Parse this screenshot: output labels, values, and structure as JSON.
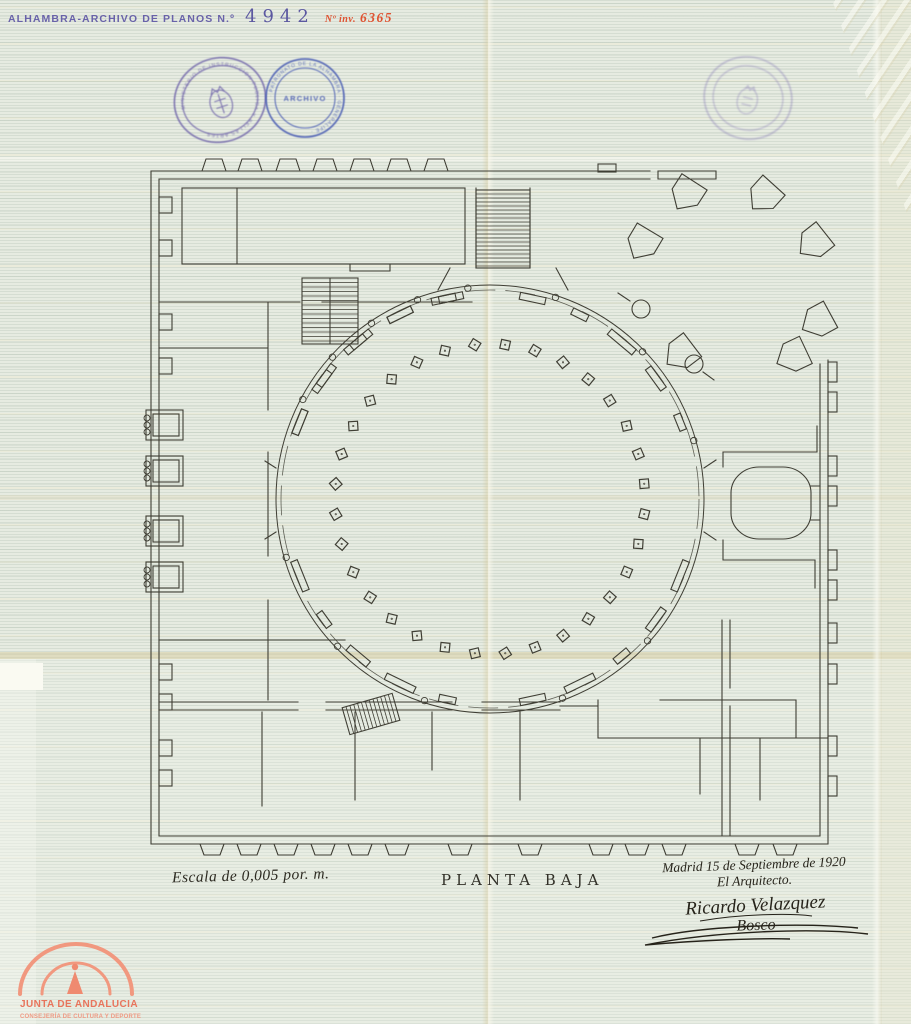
{
  "document": {
    "header": {
      "archive_label": "ALHAMBRA-ARCHIVO DE PLANOS N.º",
      "plan_number": "4942",
      "inventory_label": "Nº inv.",
      "inventory_number": "6365"
    },
    "stamps": {
      "ministry": {
        "ring_text": "MINISTERIO DE INSTRUCCION PUBLICA Y BELLAS ARTES",
        "color": "#6c60a8"
      },
      "archive": {
        "center_text": "ARCHIVO",
        "ring_text": "· PATRONATO DE LA ALHAMBRA · GENERALIFE ·",
        "color": "#4c5fb4"
      }
    },
    "annotations": {
      "scale_note": "Escala de 0,005 por. m.",
      "title": "PLANTA BAJA",
      "date_line": "Madrid 15 de Septiembre de 1920",
      "architect_line": "El Arquitecto.",
      "signature_name": "Ricardo Velazquez",
      "signature_surname": "Bosco"
    },
    "footer_logo": {
      "line1": "JUNTA DE ANDALUCIA",
      "line2": "CONSEJERÍA DE CULTURA Y DEPORTE",
      "color": "#e8745c"
    }
  },
  "plan": {
    "ink_color": "#3f3e34",
    "center_x": 490,
    "center_y": 499,
    "outer_radius": 214,
    "wall_radius": 205,
    "column_ring_radius": 155,
    "column_count": 32,
    "column_size": 9
  }
}
